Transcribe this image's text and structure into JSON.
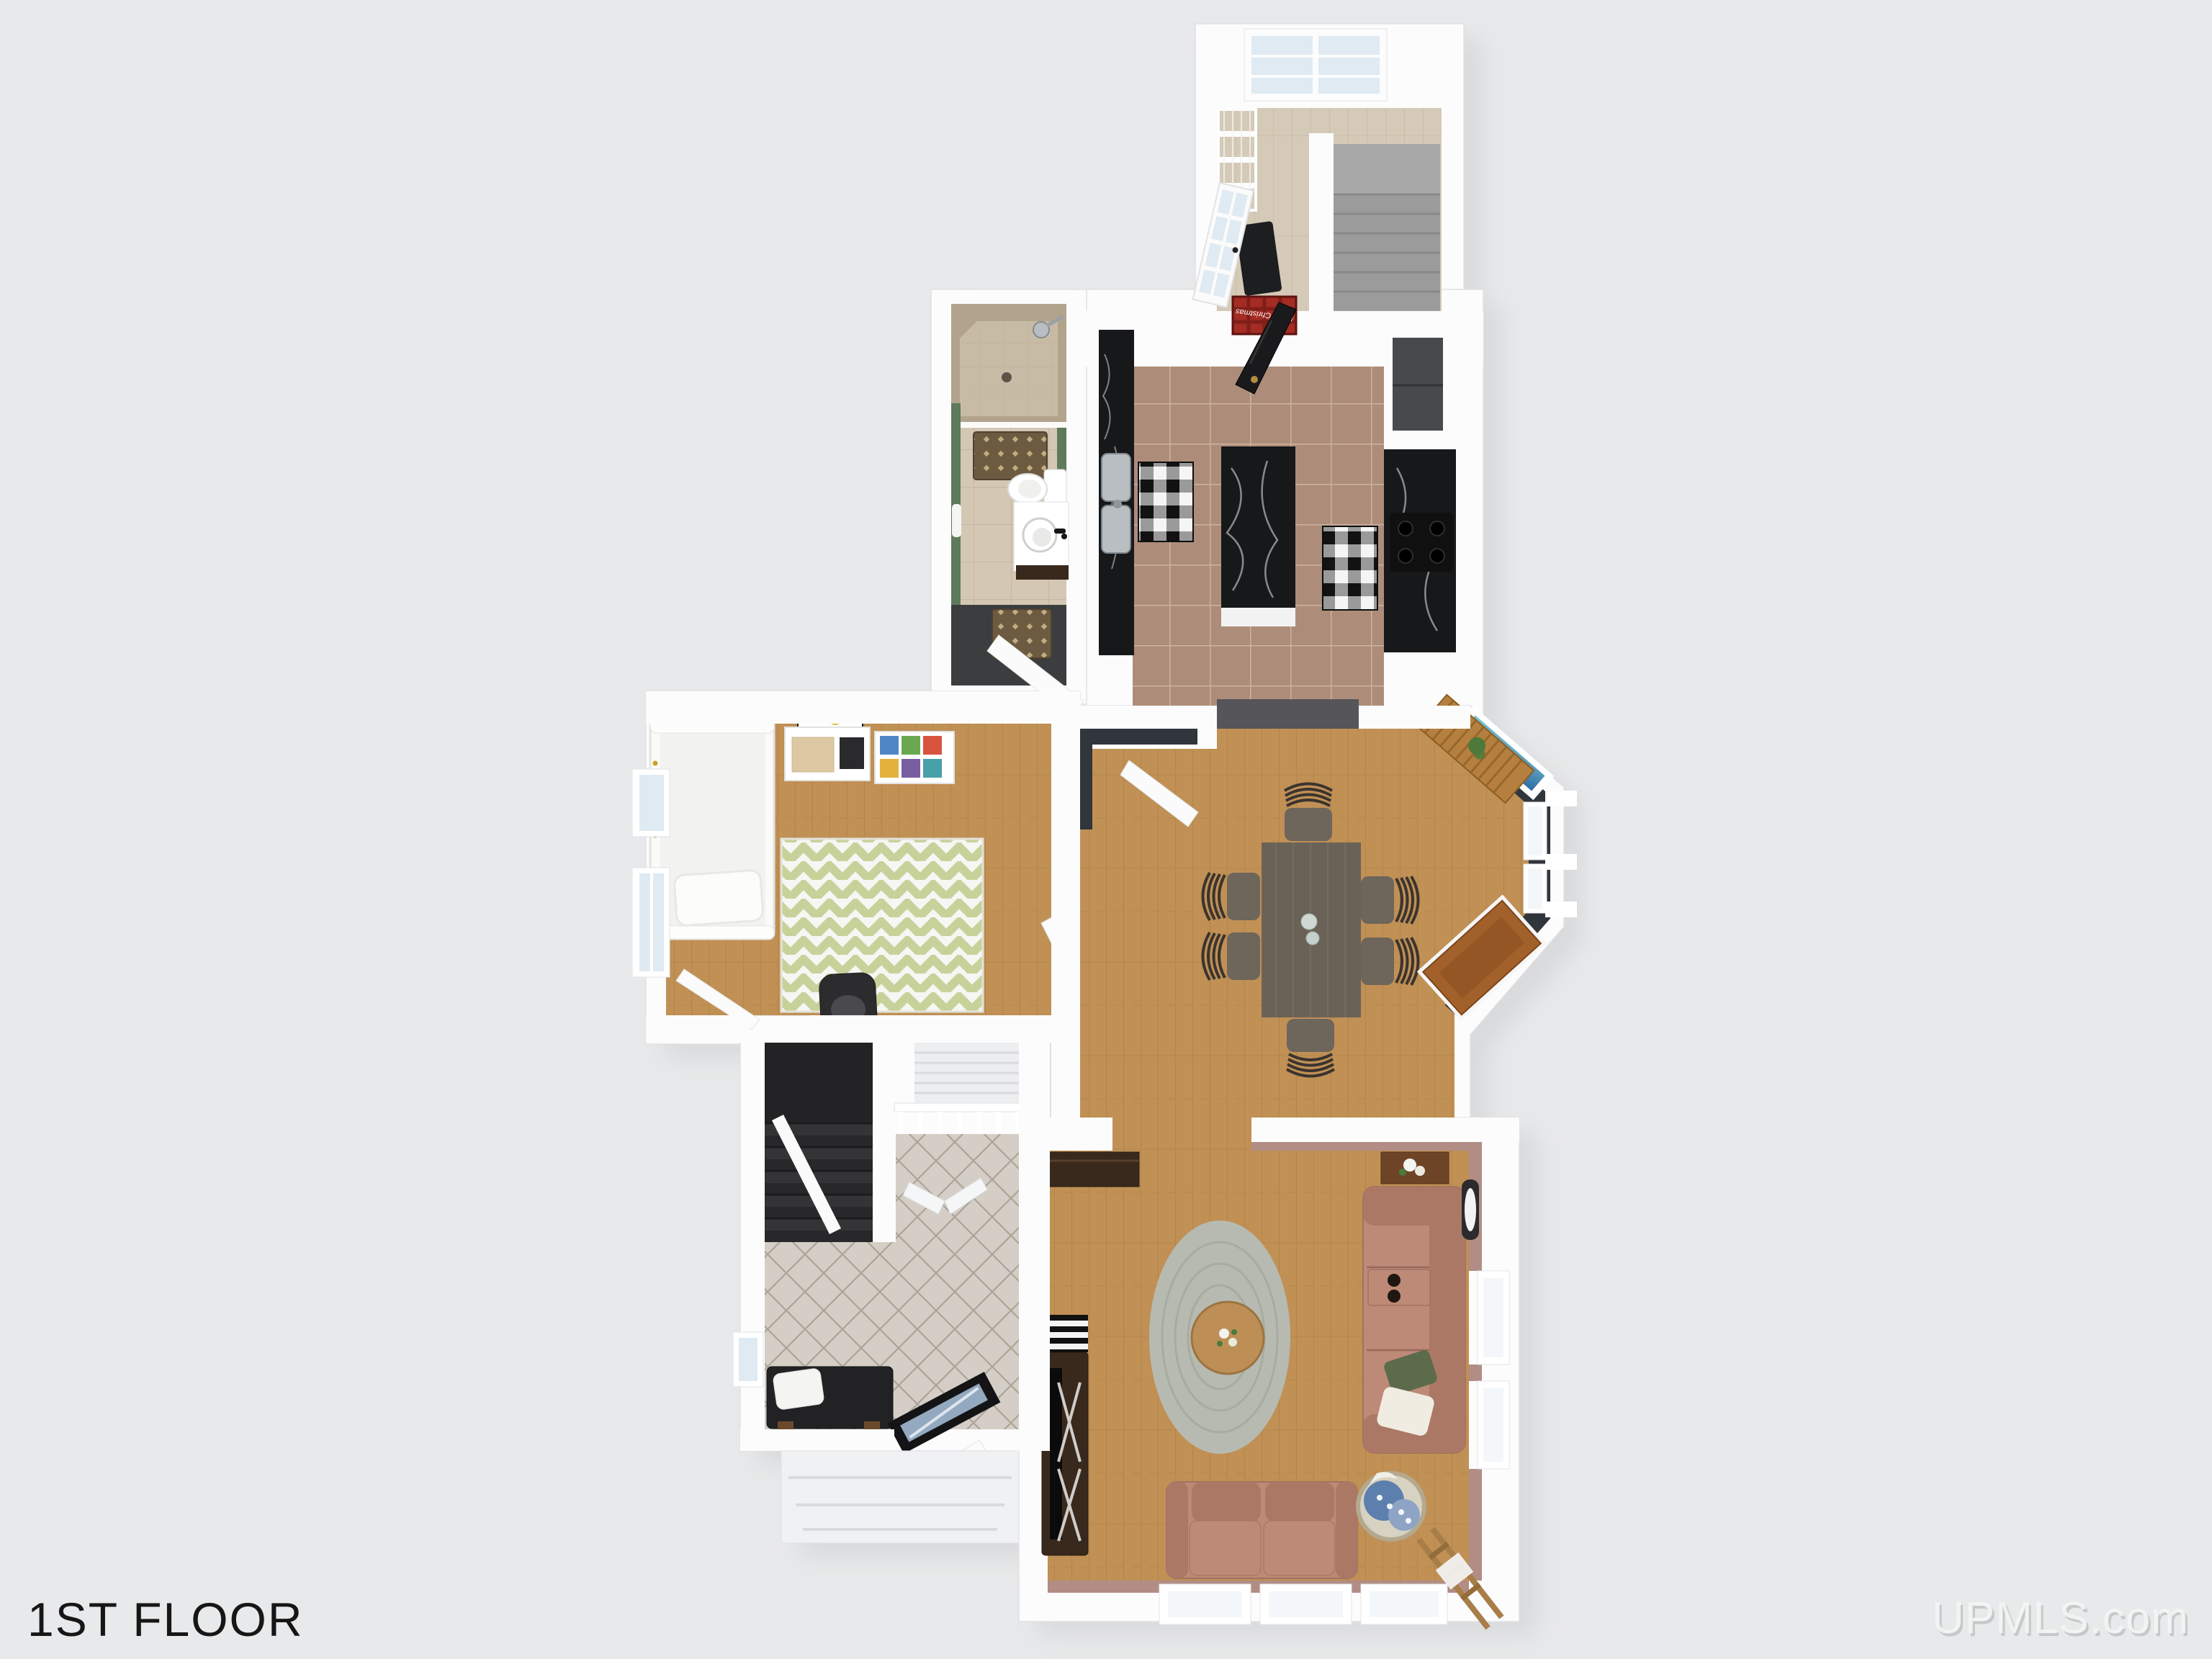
{
  "title": "1ST FLOOR",
  "watermark": {
    "text": "UPMLS.com"
  },
  "mudroom": {
    "doormat_text": "Merry Christmas"
  },
  "colors": {
    "bg": "#e8e9ea",
    "wall": "#fcfcfd",
    "wallEdge": "#e0e1e3",
    "shadow": "#c9cbcd",
    "ink": "#161616",
    "watermark": "#f4f5f5",
    "watermarkShadow": "#bdbebf",
    "woodMain": "#c09055",
    "woodLine": "#a3793f",
    "woodLight": "#d5cab7",
    "woodLightLine": "#c0b29c",
    "tileKitchen": "#ad8d7a",
    "tileKitchenLine": "#cfb6a5",
    "tileBath": "#d4c8b5",
    "tileBathLine": "#c0b29c",
    "showerTile": "#c8bba6",
    "showerWall": "#b2a48c",
    "tileFoyer": "#d4cec6",
    "tileFoyerLine": "#a59c90",
    "slate": "#3b3d3e",
    "greenWall": "#5d7a5b",
    "navyWall": "#31353c",
    "mauve": "#b18d85",
    "marble": "#17181a",
    "marbleVein": "#e8e8e8",
    "islandBase": "#f2f2f2",
    "steel": "#b9bec3",
    "steelDark": "#8f969c",
    "checkDark": "#121212",
    "checkLight": "#f5f5f5",
    "checkMid": "#9a9a9a",
    "chevron": "#c7d29b",
    "rugWhite": "#f6f6f3",
    "ovalRug": "#b7bab0",
    "ovalRugLine": "#a4a79b",
    "coffeeWood": "#bd8f57",
    "sofa": "#bd8a77",
    "sofaDark": "#ab7866",
    "sofaLine": "#97685a",
    "pillowGreen": "#5c6b4c",
    "pillowCream": "#f1ece2",
    "darkWood": "#39291d",
    "tv": "#0b0b0c",
    "tableWood": "#6b6257",
    "tableGrain": "#7b7267",
    "chairWood": "#6e655b",
    "chairSlat": "#3b342e",
    "benchWood": "#b5803f",
    "benchLine": "#8f6227",
    "cabinetWood": "#a2602b",
    "cabinetDark": "#7c4518",
    "fridge": "#474a4c",
    "stairDark": "#28282a",
    "stairDarkFace": "#343437",
    "stairDarkEdge": "#1b1b1d",
    "stairGray": "#9b9b9b",
    "stairGrayEdge": "#898989",
    "stairWhite": "#eceef0",
    "stairWhiteEdge": "#d8dadc",
    "glassBlue": "#dfeaf2",
    "glassPale": "#f3f7f9",
    "tealTop": "#79c2cf",
    "tealBottom": "#2f6da5",
    "stormGlass": "#93a9c0",
    "redRug": "#a32c24",
    "redRugDark": "#6e1713",
    "basket": "#d8d2c2",
    "basketEdge": "#b4a98e",
    "blanketBlue": "#5d7fae",
    "doorWhite": "#fbfbfb",
    "doorBlack": "#1a1a1c",
    "brownRug": "#6d5b41",
    "brownRugDot": "#c9b68a",
    "plant": "#4d7a3a",
    "gold": "#c9a227",
    "porch": "#eff1f2",
    "porchLine": "#d9dbdd"
  }
}
